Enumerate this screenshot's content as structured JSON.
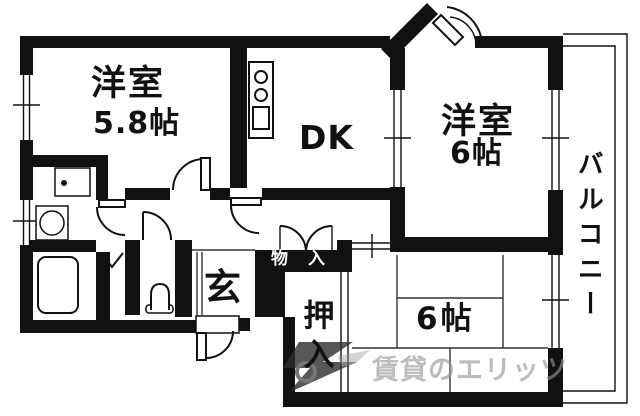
{
  "floorplan": {
    "rooms": {
      "western1": {
        "name": "洋室",
        "size": "5.8帖"
      },
      "dk": {
        "label": "DK"
      },
      "western2": {
        "name": "洋室",
        "size": "6帖"
      },
      "tatami": {
        "label": "6帖"
      },
      "balcony": {
        "label": "バルコニー"
      },
      "entrance": {
        "label": "玄"
      },
      "storage": {
        "label": "物入"
      },
      "closet": {
        "label": "押入"
      }
    },
    "watermark": {
      "text": "賃貸のエリッツ"
    },
    "fixtures": [
      "kitchen-counter",
      "stove-burners",
      "kitchen-sink",
      "washing-machine-pan",
      "washbasin",
      "bathtub",
      "toilet"
    ],
    "colors": {
      "wall": "#111111",
      "background": "#ffffff",
      "tatami_line": "#333333",
      "watermark_text": "#969696",
      "watermark_logo": "#2e2e2e"
    }
  }
}
